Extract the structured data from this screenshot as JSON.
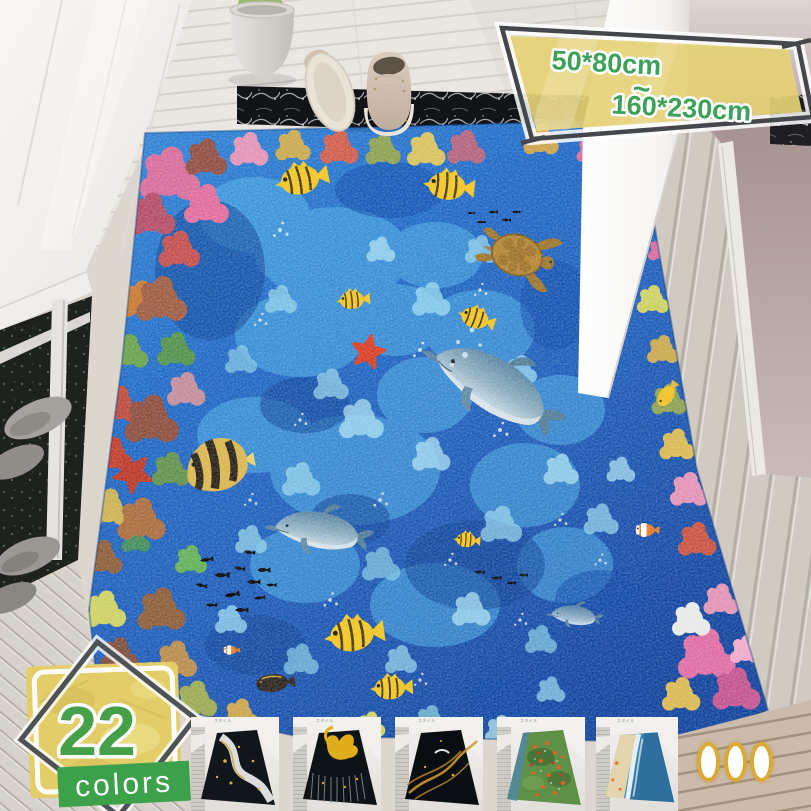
{
  "size_banner": {
    "min_size": "50*80cm",
    "tilde": "~",
    "max_size": "160*230cm",
    "bg_color": "#e8d477",
    "text_color": "#3da159"
  },
  "colors_badge": {
    "count": "22",
    "label": "colors",
    "count_color": "#45a049",
    "ribbon_color": "#3da04b",
    "paper_color": "#e2cd68"
  },
  "thumbnails": [
    {
      "name": "golden-road-deer-rug",
      "watermark": "スタイル"
    },
    {
      "name": "golden-swan-rug",
      "watermark": "スタイル"
    },
    {
      "name": "golden-wave-lines-rug",
      "watermark": "スタイル"
    },
    {
      "name": "koi-pond-rug",
      "watermark": "スタイル"
    },
    {
      "name": "beach-wave-rug",
      "watermark": "スタイル"
    }
  ],
  "pagination": {
    "dot_count": 3,
    "dot_ring_color": "#d9ab36"
  }
}
